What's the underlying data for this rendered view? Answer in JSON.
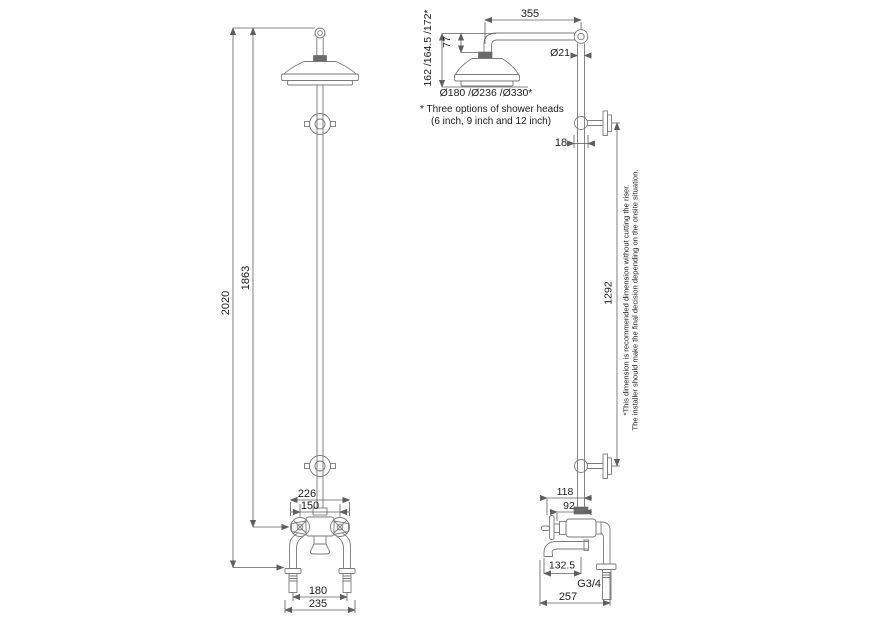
{
  "drawing": {
    "type": "technical-dimension-drawing",
    "subject": "exposed shower column with bath spout (front and side elevations)",
    "colors": {
      "background": "#ffffff",
      "line": "#7a7a7a",
      "dimension_line": "#5f5f5f",
      "text": "#1c1c1c"
    },
    "front": {
      "overall_height": "2020",
      "height_to_valve": "1863",
      "handle_span": "226",
      "handle_centers": "150",
      "leg_centers": "180",
      "base_width": "235"
    },
    "side": {
      "arm_reach": "355",
      "head_drop": "162 /164.5 /172*",
      "arm_to_head_top": "77",
      "riser_diameter": "Ø21",
      "head_diameters": "Ø180 /Ø236 /Ø330*",
      "bracket_offset": "18",
      "bracket_spacing": "1292",
      "inlet_offset_outer": "118",
      "inlet_offset_inner": "92",
      "spout_reach": "132.5",
      "connection_thread": "G3/4",
      "overall_depth": "257"
    },
    "notes": {
      "head_options_line1": "* Three options of shower heads",
      "head_options_line2": "(6 inch, 9 inch and 12 inch)",
      "riser_line1": "*This dimension is recommended dimension without cutting the riser.",
      "riser_line2": "The installer should make the final decision depending on the onsite situation."
    }
  }
}
